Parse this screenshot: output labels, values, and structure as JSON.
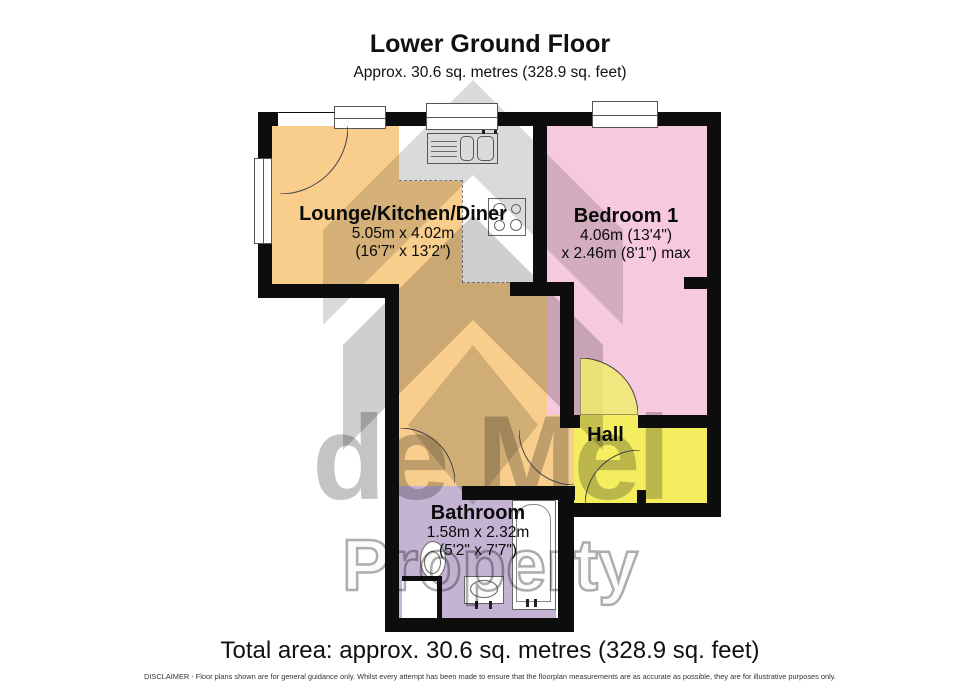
{
  "header": {
    "title": "Lower Ground Floor",
    "subtitle": "Approx. 30.6 sq. metres (328.9 sq. feet)"
  },
  "rooms": {
    "lounge": {
      "name": "Lounge/Kitchen/Diner",
      "dim_metric": "5.05m x 4.02m",
      "dim_imperial": "(16'7\" x 13'2\")"
    },
    "bedroom": {
      "name": "Bedroom 1",
      "dim_metric": "4.06m (13'4\")",
      "dim_imperial": "x 2.46m (8'1\") max"
    },
    "hall": {
      "name": "Hall"
    },
    "bathroom": {
      "name": "Bathroom",
      "dim_metric": "1.58m x 2.32m",
      "dim_imperial": "(5'2\" x 7'7\")"
    }
  },
  "watermark": {
    "line1": "de Mel",
    "line2": "Property"
  },
  "footer": {
    "total_area": "Total area: approx. 30.6 sq. metres (328.9 sq. feet)",
    "disclaimer": "DISCLAIMER -  Floor plans shown are for general guidance only. Whilst every attempt has been made to ensure that the floorplan measurements are as accurate as possible, they are for illustrative purposes only."
  },
  "colors": {
    "wall": "#0d0d0d",
    "lounge_fill": "#F9CE8D",
    "bedroom_fill": "#F7C9DF",
    "hall_fill": "#F3ED5F",
    "bathroom_fill": "#C5B3D3",
    "kitchen_fill": "#FFFFFF",
    "watermark_grey": "#CFCFCF"
  }
}
